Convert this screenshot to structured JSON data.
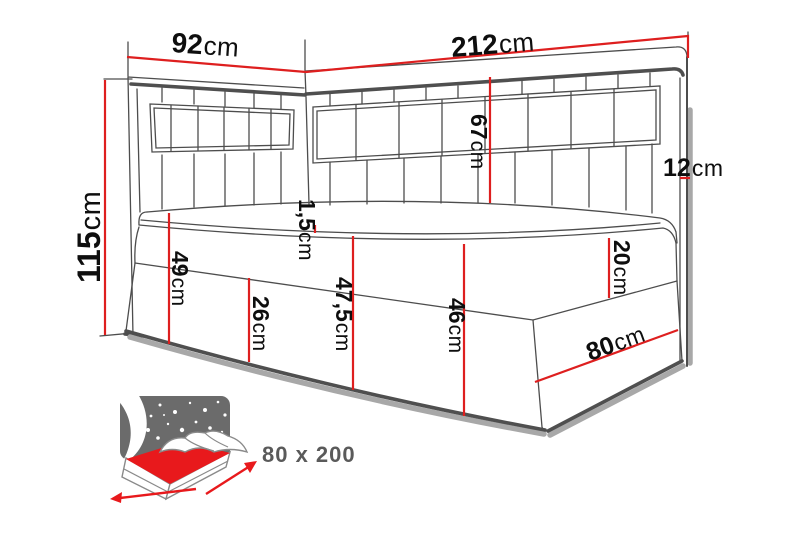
{
  "diagram": {
    "title_semantic": "corner bed dimension diagram",
    "dims": {
      "d92": {
        "num": "92",
        "unit": "cm"
      },
      "d212": {
        "num": "212",
        "unit": "cm"
      },
      "d115": {
        "num": "115",
        "unit": "cm"
      },
      "d67": {
        "num": "67",
        "unit": "cm"
      },
      "d12": {
        "num": "12",
        "unit": "cm"
      },
      "d1_5": {
        "num": "1,5",
        "unit": "cm"
      },
      "d49": {
        "num": "49",
        "unit": "cm"
      },
      "d26": {
        "num": "26",
        "unit": "cm"
      },
      "d47_5": {
        "num": "47,5",
        "unit": "cm"
      },
      "d46": {
        "num": "46",
        "unit": "cm"
      },
      "d20": {
        "num": "20",
        "unit": "cm"
      },
      "d80": {
        "num": "80",
        "unit": "cm"
      }
    },
    "icon": {
      "size_label": "80 x 200"
    },
    "colors": {
      "dimension_red": "#de1f1f",
      "outline_gray": "#4d4d4d",
      "label_black": "#0e0e0e",
      "icon_headboard_gray": "#6b6b6b"
    }
  }
}
